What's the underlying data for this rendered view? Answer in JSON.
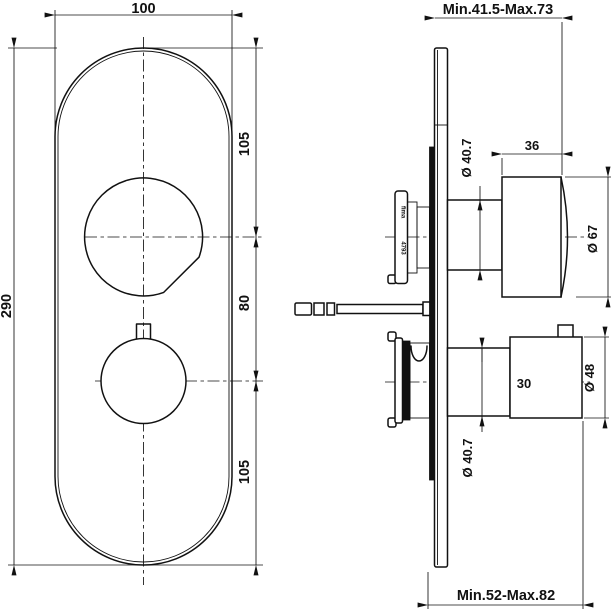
{
  "drawing": {
    "type": "technical-dimension-drawing",
    "subject": "concealed thermostatic mixer valve, front and side views",
    "colors": {
      "line": "#111111",
      "background": "#ffffff"
    },
    "front": {
      "dim_width": "100",
      "dim_height": "290",
      "dim_seg_top": "105",
      "dim_seg_mid": "80",
      "dim_seg_bottom": "105"
    },
    "side": {
      "dim_depth_top": "Min.41.5-Max.73",
      "dim_depth_bottom": "Min.52-Max.82",
      "dim_shaft_upper": "Ø 40.7",
      "dim_knob_upper_depth": "36",
      "dim_knob_upper_dia": "Ø 67",
      "dim_knob_lower_depth": "30",
      "dim_knob_lower_dia": "Ø 48",
      "dim_shaft_lower": "Ø 40.7",
      "marking_brand": "fima",
      "marking_code": "4793"
    }
  }
}
